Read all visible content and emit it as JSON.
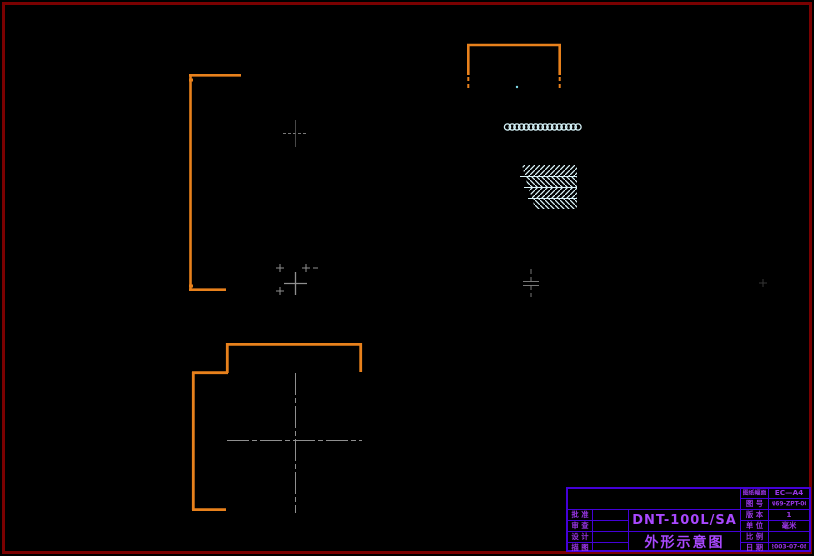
{
  "page": {
    "background": "#000000",
    "frame_color": "#7a0101"
  },
  "drawing": {
    "colors": {
      "outline_orange": "#e8811c",
      "centerline_gray": "#8f8f8f",
      "hatch_cyan": "#d9f3f8",
      "terminal_circle": "#d5f2f8",
      "dot_cyan": "#7fdbe8"
    },
    "terminal_count": 16,
    "views": {
      "side_bracket": "left-side-profile-view",
      "top_bracket": "top-cover-view",
      "hatch_block": "hatched-terminal-block",
      "base_outline": "bottom-base-view"
    }
  },
  "title_block": {
    "line_color": "#4400d8",
    "text_color": "#9a36e6",
    "model": "DNT-100L/SA",
    "drawing_title": "外形示意图",
    "left_rows": [
      {
        "label": "批 准",
        "value": ""
      },
      {
        "label": "审 查",
        "value": ""
      },
      {
        "label": "设 计",
        "value": ""
      },
      {
        "label": "描 图",
        "value": ""
      }
    ],
    "right_rows": [
      {
        "label": "图纸幅面",
        "value": "EC—A4"
      },
      {
        "label": "图 号",
        "value": "DN69-ZPT-001"
      },
      {
        "label": "版 本",
        "value": "1"
      },
      {
        "label": "单 位",
        "value": "毫米"
      },
      {
        "label": "比 例",
        "value": ""
      },
      {
        "label": "日 期",
        "value": "2003-07-08"
      }
    ]
  }
}
